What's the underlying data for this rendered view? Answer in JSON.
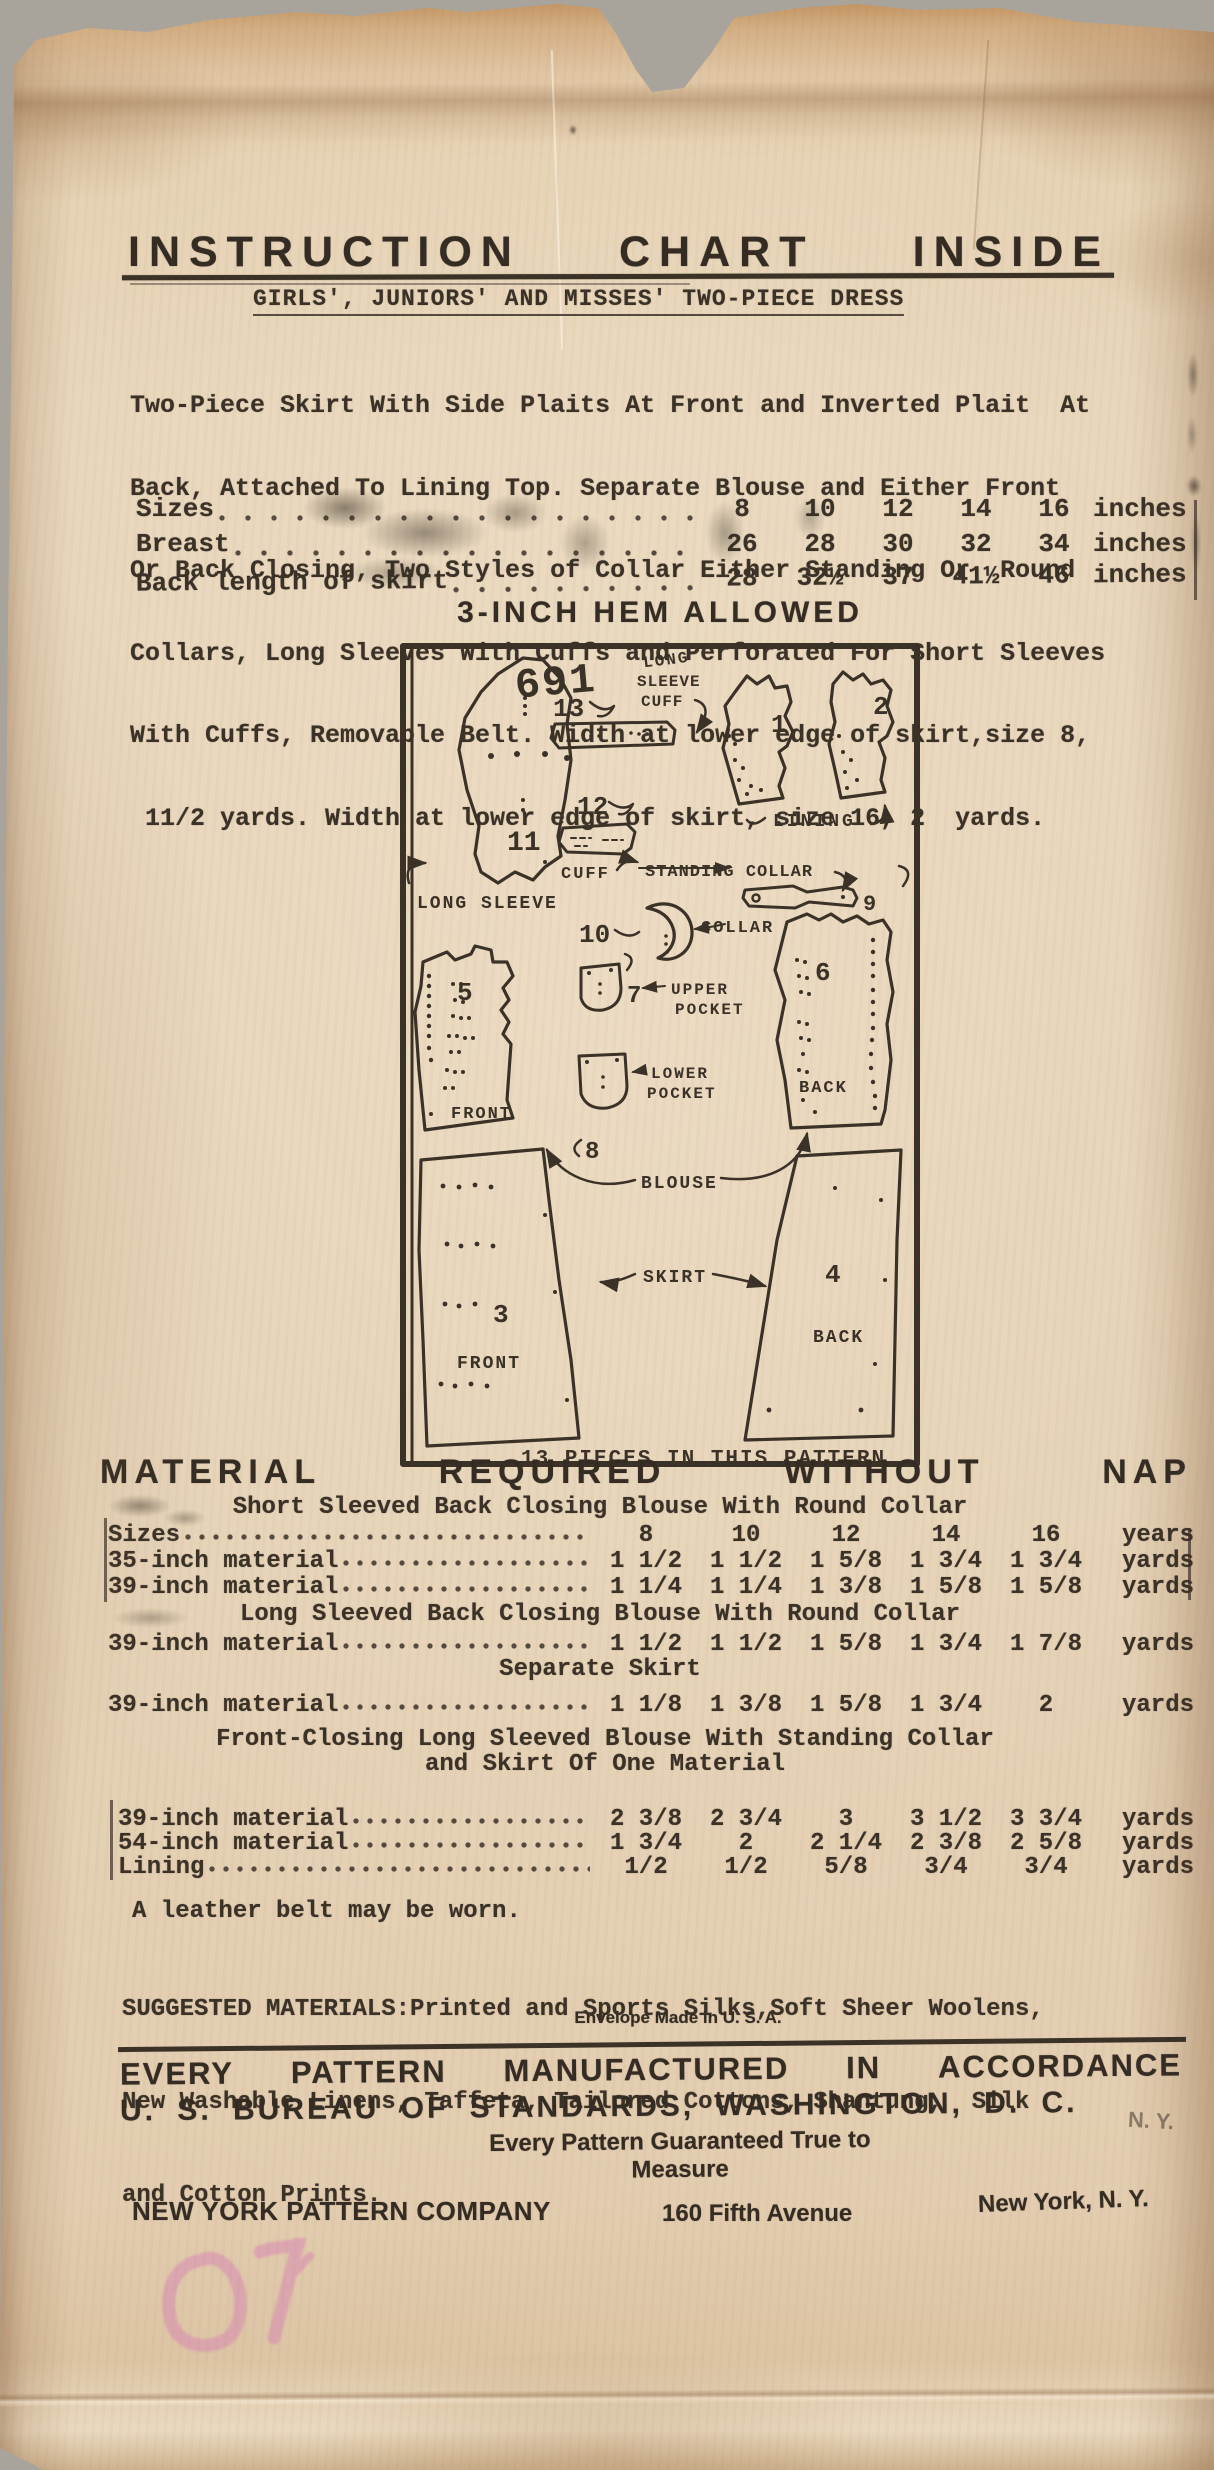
{
  "header": {
    "title_words": [
      "INSTRUCTION",
      "CHART",
      "INSIDE"
    ],
    "subtitle": "GIRLS', JUNIORS' AND MISSES' TWO-PIECE DRESS",
    "description_lines": [
      "Two-Piece Skirt With Side Plaits At Front and Inverted Plait  At",
      "Back, Attached To Lining Top. Separate Blouse and Either Front",
      "Or Back Closing, Two Styles of Collar Either Standing Or  Round",
      "Collars, Long Sleeves With Cuffs and Perforated For Short Sleeves",
      "With Cuffs, Removable Belt. Width at lower edge of skirt,size 8,",
      " 11/2 yards. Width at lower edge of skirt, size 16, 2  yards."
    ]
  },
  "size_table": {
    "rows": [
      {
        "label": "Sizes",
        "values": [
          "8",
          "10",
          "12",
          "14",
          "16"
        ],
        "unit": "inches"
      },
      {
        "label": "Breast",
        "values": [
          "26",
          "28",
          "30",
          "32",
          "34"
        ],
        "unit": "inches"
      },
      {
        "label": "Back length of skirt",
        "values": [
          "28",
          "32½",
          "37",
          "41½",
          "46"
        ],
        "unit": "inches"
      }
    ]
  },
  "hem_note": "3-INCH HEM ALLOWED",
  "diagram": {
    "pattern_number": "691",
    "pieces_note": "13 PIECES IN THIS PATTERN",
    "numbers": {
      "n1": "1",
      "n2": "2",
      "n3": "3",
      "n4": "4",
      "n5": "5",
      "n6": "6",
      "n7": "7",
      "n8": "8",
      "n9": "9",
      "n10": "10",
      "n11": "11",
      "n12": "12",
      "n13": "13"
    },
    "labels": {
      "long_l1": "LONG",
      "long_l2": "SLEEVE",
      "long_l3": "CUFF",
      "long_sleeve": "LONG SLEEVE",
      "cuff": "CUFF",
      "standing_collar": "STANDING COLLAR",
      "lining": "LINING",
      "collar": "COLLAR",
      "upper_l1": "UPPER",
      "upper_l2": "POCKET",
      "lower_l1": "LOWER",
      "lower_l2": "POCKET",
      "blouse": "BLOUSE",
      "skirt": "SKIRT",
      "front_blouse": "FRONT",
      "back_blouse": "BACK",
      "front_skirt": "FRONT",
      "back_skirt": "BACK"
    }
  },
  "material": {
    "title_words": [
      "MATERIAL",
      "REQUIRED",
      "WITHOUT",
      "NAP"
    ],
    "sections": [
      {
        "heading": "Short Sleeved Back Closing Blouse With Round Collar",
        "rows": [
          {
            "label": "Sizes",
            "values": [
              "8",
              "10",
              "12",
              "14",
              "16"
            ],
            "unit": "years"
          },
          {
            "label": "35-inch material",
            "values": [
              "1 1/2",
              "1 1/2",
              "1 5/8",
              "1 3/4",
              "1 3/4"
            ],
            "unit": "yards"
          },
          {
            "label": "39-inch material",
            "values": [
              "1 1/4",
              "1 1/4",
              "1 3/8",
              "1 5/8",
              "1 5/8"
            ],
            "unit": "yards"
          }
        ]
      },
      {
        "heading": "Long Sleeved Back Closing Blouse With Round Collar",
        "rows": [
          {
            "label": "39-inch material",
            "values": [
              "1 1/2",
              "1 1/2",
              "1 5/8",
              "1 3/4",
              "1 7/8"
            ],
            "unit": "yards"
          }
        ]
      },
      {
        "heading": "Separate Skirt",
        "rows": [
          {
            "label": "39-inch material",
            "values": [
              "1 1/8",
              "1 3/8",
              "1 5/8",
              "1 3/4",
              "2"
            ],
            "unit": "yards"
          }
        ]
      },
      {
        "heading": "Front-Closing Long Sleeved Blouse With Standing Collar",
        "heading2": "and Skirt Of One Material",
        "rows": [
          {
            "label": "39-inch material",
            "values": [
              "2 3/8",
              "2 3/4",
              "3",
              "3 1/2",
              "3 3/4"
            ],
            "unit": "yards"
          },
          {
            "label": "54-inch material",
            "values": [
              "1 3/4",
              "2",
              "2 1/4",
              "2 3/8",
              "2 5/8"
            ],
            "unit": "yards"
          },
          {
            "label": "Lining",
            "values": [
              "1/2",
              "1/2",
              "5/8",
              "3/4",
              "3/4"
            ],
            "unit": "yards"
          }
        ]
      }
    ]
  },
  "notes": {
    "belt": "A leather belt may be worn.",
    "suggested_lines": [
      "SUGGESTED MATERIALS:Printed and Sports Silks,Soft Sheer Woolens,",
      "New Washable Linens, Taffeta, Tailored Cottons, Shantung,  Silk",
      "and Cotton Prints."
    ],
    "made_in": "Envelope Made in U. S. A."
  },
  "footer": {
    "line1_words": [
      "EVERY",
      "PATTERN",
      "MANUFACTURED",
      "IN",
      "ACCORDANCE"
    ],
    "line2": "U. S. BUREAU OF STANDARDS, WASHINGTON, D. C.",
    "guarantee": "Every Pattern Guaranteed True to Measure",
    "ny_mark": "N. Y.",
    "company": "NEW YORK PATTERN COMPANY",
    "address": "160 Fifth Avenue",
    "city": "New York, N. Y."
  },
  "colors": {
    "paper": "#e6d2b4",
    "ink": "#3a3127",
    "stamp_pink": "#d884b4"
  }
}
